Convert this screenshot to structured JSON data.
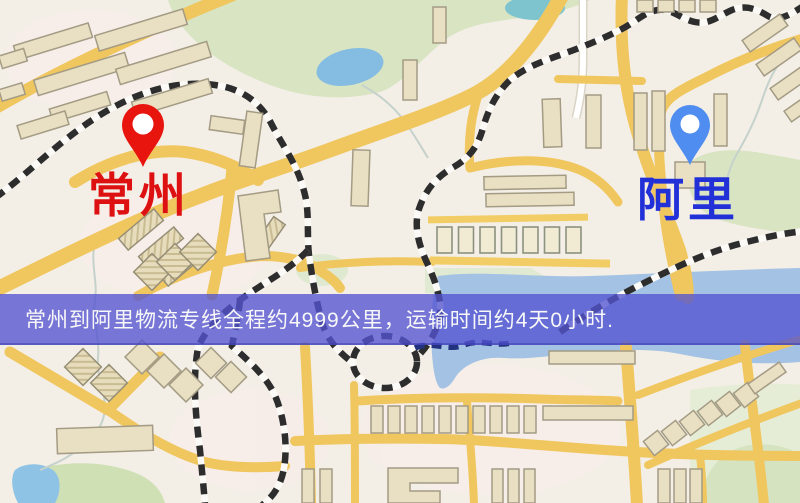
{
  "banner": {
    "text": "常州到阿里物流专线全程约4999公里，运输时间约4天0小时."
  },
  "origin": {
    "label": "常州",
    "pin_color": "#e8150f",
    "label_color": "#dd1111"
  },
  "destination": {
    "label": "阿里",
    "pin_color": "#4f8df0",
    "label_color": "#2230d8"
  },
  "colors": {
    "banner_overlay": "#5353d1",
    "banner_text": "#f8f8f8",
    "map_background": "#f4efe6",
    "road_yellow": "#f0c65f",
    "building_beige": "#e9dfc2",
    "green_area": "#d8e4c2",
    "water_blue": "#9fc0e4",
    "railway_black": "#2d2d2d"
  }
}
